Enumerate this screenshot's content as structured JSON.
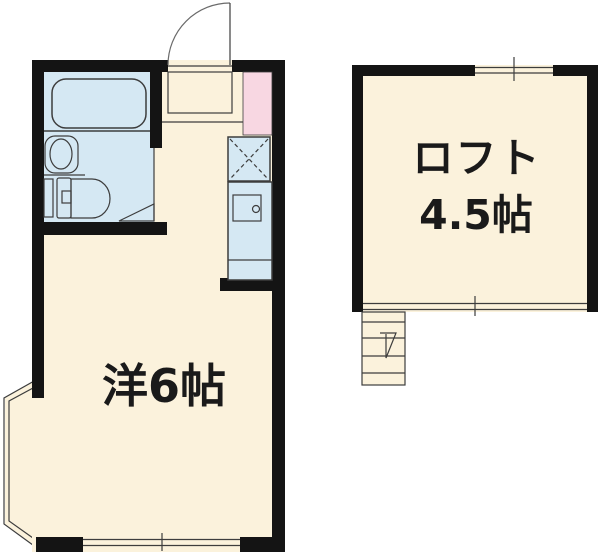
{
  "plan": {
    "type": "apartment-floor-plan",
    "main_room_label": "洋6帖",
    "loft_label": "ロフト",
    "loft_area_label": "4.5帖"
  },
  "icons": {
    "entrance-door": "quarter-arc-swing-door",
    "entrance-step": "outlined-rectangle-with-step-line",
    "bathtub": "rounded-rectangle-outline",
    "washbasin": "oval-in-rounded-box",
    "toilet": "tank-with-rounded-bowl",
    "bathroom-door": "triangle-swing-marker",
    "stove-space": "dashed-x-crossed-box",
    "kitchen-counter": "cabinet-rect-with-round-knob",
    "refrigerator-space": "pink-rectangle",
    "bay-window": "angled-parallel-double-lines",
    "window": "double-line-with-center-tick",
    "stairs": "tread-lines-with-direction-arrow"
  },
  "colors": {
    "background": "#ffffff",
    "floor": "#fbf2dc",
    "fixture": "#d5e8f3",
    "accent_pink": "#f8d7e2",
    "wall": "#141414",
    "line": "#3d3d3d",
    "text": "#1a1a1a"
  }
}
